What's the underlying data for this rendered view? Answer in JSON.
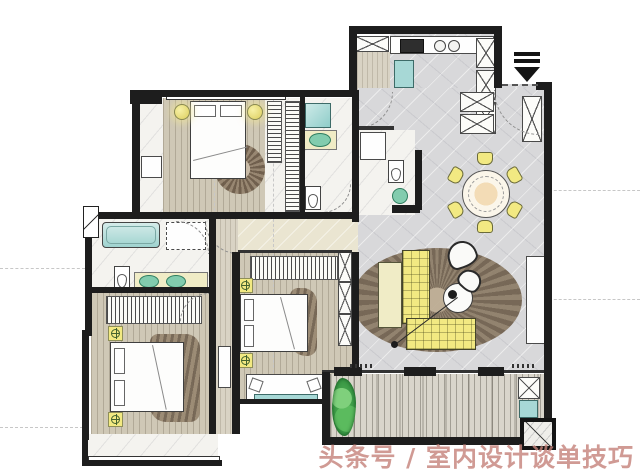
{
  "watermark": {
    "text": "头条号 / 室内设计谈单技巧"
  },
  "palette": {
    "wall": "#1d1d1d",
    "wood": "#cfc8b6",
    "marble": "#d8d8da",
    "marble_white": "#f4f3ef",
    "cream": "#eae5d1",
    "deck": "#d9d5cb",
    "yellow": "#f2e982",
    "pale_yellow": "#f0ecc6",
    "aqua": "#a7d8d6",
    "green_fixture": "#82ccae",
    "watermark": "#c5827a"
  },
  "plan": {
    "type": "floor-plan",
    "style": "hand-rendered interior design presentation plan",
    "rooms": [
      {
        "name": "master-bedroom",
        "floor": "wood",
        "furniture": [
          "double-bed",
          "two-round-bedside-lamps",
          "round-rug",
          "wardrobe",
          "desk"
        ]
      },
      {
        "name": "master-bathroom",
        "floor": "white-marble",
        "furniture": [
          "shower",
          "vanity-sink",
          "toilet"
        ]
      },
      {
        "name": "walk-in-closet",
        "floor": "white-marble",
        "furniture": [
          "hanging-rails"
        ]
      },
      {
        "name": "kitchen",
        "floor": "tile",
        "furniture": [
          "counter-with-sink",
          "cooktop",
          "island-unit",
          "tall-cabinets",
          "pantry-cabinet"
        ]
      },
      {
        "name": "entry",
        "floor": "marble",
        "furniture": [
          "shoe-cabinets",
          "entrance-arrow"
        ]
      },
      {
        "name": "dining-room",
        "floor": "marble",
        "furniture": [
          "round-dining-table",
          "six-dining-chairs"
        ]
      },
      {
        "name": "guest-toilet",
        "floor": "white-marble",
        "furniture": [
          "shower",
          "toilet",
          "round-sink"
        ]
      },
      {
        "name": "living-room",
        "floor": "marble",
        "furniture": [
          "l-shaped-sofa",
          "chaise-bench",
          "round-coffee-table",
          "arc-floor-lamp",
          "two-accent-chairs",
          "tv-console",
          "large-round-rug",
          "side-cabinet"
        ]
      },
      {
        "name": "bedroom-2",
        "floor": "wood",
        "furniture": [
          "bed",
          "wardrobe",
          "rug",
          "nightstand-lamps",
          "window-seat"
        ]
      },
      {
        "name": "bedroom-3",
        "floor": "wood",
        "furniture": [
          "bed",
          "wardrobe",
          "rug",
          "nightstand-lamps",
          "bay-window"
        ]
      },
      {
        "name": "shared-bathroom",
        "floor": "white-marble",
        "furniture": [
          "bathtub",
          "shower",
          "double-vanity-sinks",
          "toilet"
        ]
      },
      {
        "name": "balcony",
        "floor": "wood-decking",
        "furniture": [
          "plant",
          "storage-cabinet",
          "utility-sink"
        ]
      }
    ]
  }
}
